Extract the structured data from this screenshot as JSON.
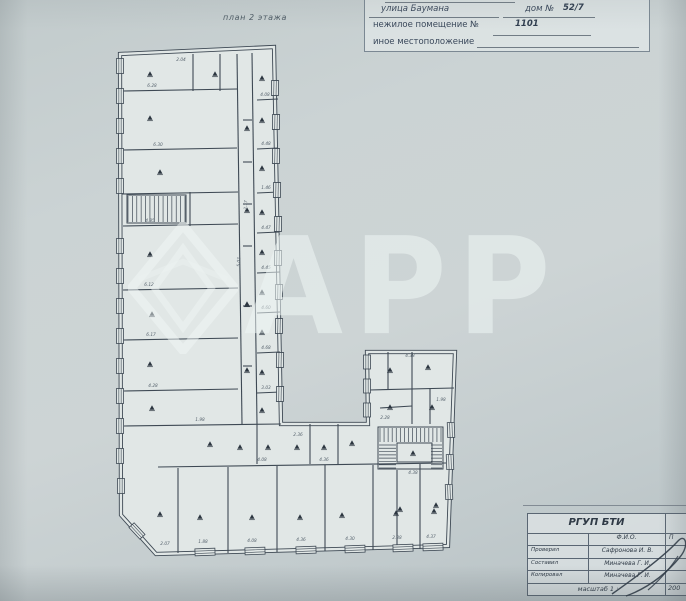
{
  "plan_label": "план 2 этажа",
  "address": {
    "line1_street": "улица Баумана",
    "line1_house_label": "дом №",
    "line1_house_value": "52/7",
    "line2_label": "нежилое помещение №",
    "line2_value": "1101",
    "line3_label": "иное местоположение"
  },
  "watermark": {
    "text": "АРР"
  },
  "titleblock": {
    "org": "РГУП БТИ",
    "col_fio": "Ф.И.О.",
    "col_sign": "П",
    "rows": [
      {
        "role": "Проверил",
        "name": "Сафронова И. В."
      },
      {
        "role": "Составил",
        "name": "Миначева Г. И."
      },
      {
        "role": "Копировал",
        "name": "Миначева Г. И."
      }
    ],
    "scale_label": "масштаб 1 :",
    "scale_value": "200"
  },
  "plan": {
    "colors": {
      "line": "#3e4954",
      "room": "#e1e7e6",
      "dim": "#56626d",
      "marker": "#2c3640"
    },
    "outline": [
      [
        120,
        54
      ],
      [
        274,
        47
      ],
      [
        281,
        424
      ],
      [
        368,
        424
      ],
      [
        367,
        352
      ],
      [
        455,
        352
      ],
      [
        448,
        546
      ],
      [
        156,
        554
      ],
      [
        121,
        515
      ]
    ],
    "walls": [
      [
        237,
        54,
        242,
        424
      ],
      [
        252,
        53,
        257,
        424
      ],
      [
        193,
        54,
        193,
        91
      ],
      [
        220,
        54,
        220,
        91
      ],
      [
        122,
        91,
        237,
        89
      ],
      [
        122,
        150,
        237,
        148
      ],
      [
        122,
        194,
        238,
        192
      ],
      [
        190,
        192,
        190,
        226
      ],
      [
        123,
        226,
        238,
        224
      ],
      [
        123,
        290,
        238,
        288
      ],
      [
        123,
        340,
        238,
        338
      ],
      [
        124,
        391,
        238,
        389
      ],
      [
        124,
        426,
        281,
        424
      ],
      [
        257,
        100,
        278,
        99
      ],
      [
        257,
        149,
        278,
        148
      ],
      [
        257,
        193,
        279,
        192
      ],
      [
        257,
        233,
        279,
        232
      ],
      [
        257,
        273,
        280,
        272
      ],
      [
        257,
        313,
        280,
        312
      ],
      [
        257,
        353,
        280,
        352
      ],
      [
        257,
        393,
        281,
        392
      ],
      [
        243,
        120,
        252,
        120
      ],
      [
        243,
        162,
        252,
        162
      ],
      [
        243,
        204,
        252,
        204
      ],
      [
        243,
        246,
        252,
        246
      ],
      [
        243,
        306,
        252,
        306
      ],
      [
        243,
        366,
        252,
        366
      ],
      [
        158,
        467,
        446,
        463
      ],
      [
        257,
        424,
        257,
        464
      ],
      [
        310,
        424,
        310,
        464
      ],
      [
        338,
        424,
        338,
        464
      ],
      [
        178,
        468,
        178,
        553
      ],
      [
        228,
        467,
        228,
        553
      ],
      [
        277,
        466,
        277,
        552
      ],
      [
        325,
        465,
        325,
        551
      ],
      [
        373,
        465,
        373,
        550
      ],
      [
        420,
        464,
        420,
        549
      ],
      [
        397,
        470,
        397,
        549
      ],
      [
        412,
        352,
        412,
        424
      ],
      [
        369,
        390,
        454,
        388
      ],
      [
        388,
        352,
        388,
        390
      ],
      [
        430,
        388,
        430,
        424
      ],
      [
        380,
        408,
        412,
        406
      ]
    ],
    "windows": [
      {
        "x": 120,
        "y": 66,
        "w": 7,
        "h": 15,
        "r": 0
      },
      {
        "x": 120,
        "y": 96,
        "w": 7,
        "h": 15,
        "r": 0
      },
      {
        "x": 120,
        "y": 126,
        "w": 7,
        "h": 15,
        "r": 0
      },
      {
        "x": 120,
        "y": 156,
        "w": 7,
        "h": 15,
        "r": 0
      },
      {
        "x": 120,
        "y": 186,
        "w": 7,
        "h": 15,
        "r": 0
      },
      {
        "x": 120,
        "y": 246,
        "w": 7,
        "h": 15,
        "r": 0
      },
      {
        "x": 120,
        "y": 276,
        "w": 7,
        "h": 15,
        "r": 0
      },
      {
        "x": 120,
        "y": 306,
        "w": 7,
        "h": 15,
        "r": 0
      },
      {
        "x": 120,
        "y": 336,
        "w": 7,
        "h": 15,
        "r": 0
      },
      {
        "x": 120,
        "y": 366,
        "w": 7,
        "h": 15,
        "r": 0
      },
      {
        "x": 120,
        "y": 396,
        "w": 7,
        "h": 15,
        "r": 0
      },
      {
        "x": 120,
        "y": 426,
        "w": 7,
        "h": 15,
        "r": 0
      },
      {
        "x": 120,
        "y": 456,
        "w": 7,
        "h": 15,
        "r": 0
      },
      {
        "x": 121,
        "y": 486,
        "w": 7,
        "h": 15,
        "r": 0
      },
      {
        "x": 137,
        "y": 531,
        "w": 7,
        "h": 16,
        "r": -43
      },
      {
        "x": 275,
        "y": 88,
        "w": 7,
        "h": 15,
        "r": 1
      },
      {
        "x": 276,
        "y": 122,
        "w": 7,
        "h": 15,
        "r": 1
      },
      {
        "x": 276,
        "y": 156,
        "w": 7,
        "h": 15,
        "r": 1
      },
      {
        "x": 277,
        "y": 190,
        "w": 7,
        "h": 15,
        "r": 1
      },
      {
        "x": 278,
        "y": 224,
        "w": 7,
        "h": 15,
        "r": 1
      },
      {
        "x": 278,
        "y": 258,
        "w": 7,
        "h": 15,
        "r": 1
      },
      {
        "x": 279,
        "y": 292,
        "w": 7,
        "h": 15,
        "r": 1
      },
      {
        "x": 279,
        "y": 326,
        "w": 7,
        "h": 15,
        "r": 1
      },
      {
        "x": 280,
        "y": 360,
        "w": 7,
        "h": 15,
        "r": 1
      },
      {
        "x": 280,
        "y": 394,
        "w": 7,
        "h": 15,
        "r": 1
      },
      {
        "x": 367,
        "y": 362,
        "w": 7,
        "h": 14,
        "r": 0
      },
      {
        "x": 367,
        "y": 386,
        "w": 7,
        "h": 14,
        "r": 0
      },
      {
        "x": 367,
        "y": 410,
        "w": 7,
        "h": 14,
        "r": 0
      },
      {
        "x": 451,
        "y": 430,
        "w": 7,
        "h": 15,
        "r": -2
      },
      {
        "x": 450,
        "y": 462,
        "w": 7,
        "h": 15,
        "r": -2
      },
      {
        "x": 449,
        "y": 492,
        "w": 7,
        "h": 15,
        "r": -2
      },
      {
        "x": 205,
        "y": 552,
        "w": 7,
        "h": 20,
        "r": 88
      },
      {
        "x": 255,
        "y": 551,
        "w": 7,
        "h": 20,
        "r": 88
      },
      {
        "x": 306,
        "y": 550,
        "w": 7,
        "h": 20,
        "r": 88
      },
      {
        "x": 355,
        "y": 549,
        "w": 7,
        "h": 20,
        "r": 88
      },
      {
        "x": 403,
        "y": 548,
        "w": 7,
        "h": 20,
        "r": 88
      },
      {
        "x": 433,
        "y": 547,
        "w": 7,
        "h": 20,
        "r": 88
      }
    ],
    "stair_boxes": [
      [
        127,
        195,
        59,
        28
      ],
      [
        378,
        427,
        65,
        42
      ],
      [
        397,
        443,
        35,
        19
      ]
    ],
    "stairs": [
      {
        "x": 128,
        "y": 196,
        "w": 57,
        "h": 26,
        "n": 13,
        "dir": "v"
      },
      {
        "x": 380,
        "y": 428,
        "w": 61,
        "h": 14,
        "n": 15,
        "dir": "v"
      },
      {
        "x": 379,
        "y": 445,
        "w": 17,
        "h": 23,
        "n": 7,
        "dir": "h"
      },
      {
        "x": 431,
        "y": 445,
        "w": 11,
        "h": 23,
        "n": 7,
        "dir": "h"
      }
    ],
    "room_markers": [
      [
        150,
        74
      ],
      [
        215,
        74
      ],
      [
        262,
        78
      ],
      [
        150,
        118
      ],
      [
        262,
        120
      ],
      [
        247,
        128
      ],
      [
        160,
        172
      ],
      [
        262,
        168
      ],
      [
        150,
        254
      ],
      [
        262,
        212
      ],
      [
        247,
        210
      ],
      [
        152,
        314
      ],
      [
        262,
        252
      ],
      [
        150,
        364
      ],
      [
        262,
        292
      ],
      [
        247,
        304
      ],
      [
        152,
        408
      ],
      [
        262,
        332
      ],
      [
        262,
        372
      ],
      [
        247,
        370
      ],
      [
        262,
        410
      ],
      [
        210,
        444
      ],
      [
        240,
        447
      ],
      [
        268,
        447
      ],
      [
        297,
        447
      ],
      [
        324,
        447
      ],
      [
        352,
        443
      ],
      [
        160,
        514
      ],
      [
        200,
        517
      ],
      [
        252,
        517
      ],
      [
        300,
        517
      ],
      [
        342,
        515
      ],
      [
        396,
        513
      ],
      [
        434,
        511
      ],
      [
        390,
        370
      ],
      [
        428,
        367
      ],
      [
        390,
        407
      ],
      [
        432,
        407
      ],
      [
        413,
        453
      ],
      [
        400,
        509
      ],
      [
        436,
        505
      ]
    ],
    "dim_labels": [
      [
        181,
        61,
        "2.04",
        0
      ],
      [
        152,
        87,
        "6.28",
        0
      ],
      [
        265,
        96,
        "4.08",
        0
      ],
      [
        158,
        146,
        "6.30",
        0
      ],
      [
        266,
        145,
        "4.48",
        0
      ],
      [
        150,
        222,
        "4.85",
        0
      ],
      [
        266,
        189,
        "1.46",
        0
      ],
      [
        266,
        229,
        "4.47",
        0
      ],
      [
        149,
        286,
        "6.12",
        0
      ],
      [
        266,
        269,
        "4.45",
        0
      ],
      [
        151,
        336,
        "6.17",
        0
      ],
      [
        266,
        309,
        "4.60",
        0
      ],
      [
        153,
        387,
        "4.28",
        0
      ],
      [
        266,
        349,
        "4.68",
        0
      ],
      [
        240,
        262,
        "5.02",
        -88
      ],
      [
        247,
        205,
        "2.17",
        -88
      ],
      [
        266,
        389,
        "3.03",
        0
      ],
      [
        200,
        421,
        "1.98",
        0
      ],
      [
        298,
        436,
        "2.36",
        0
      ],
      [
        324,
        461,
        "4.36",
        0
      ],
      [
        262,
        461,
        "4.08",
        0
      ],
      [
        165,
        545,
        "2.07",
        0
      ],
      [
        203,
        543,
        "1.88",
        0
      ],
      [
        252,
        542,
        "4.08",
        0
      ],
      [
        301,
        541,
        "4.36",
        0
      ],
      [
        350,
        540,
        "4.30",
        0
      ],
      [
        397,
        539,
        "2.38",
        0
      ],
      [
        431,
        538,
        "4.37",
        0
      ],
      [
        410,
        357,
        "4.38",
        0
      ],
      [
        441,
        401,
        "1.98",
        0
      ],
      [
        385,
        419,
        "2.28",
        0
      ],
      [
        413,
        474,
        "4.38",
        0
      ]
    ]
  }
}
